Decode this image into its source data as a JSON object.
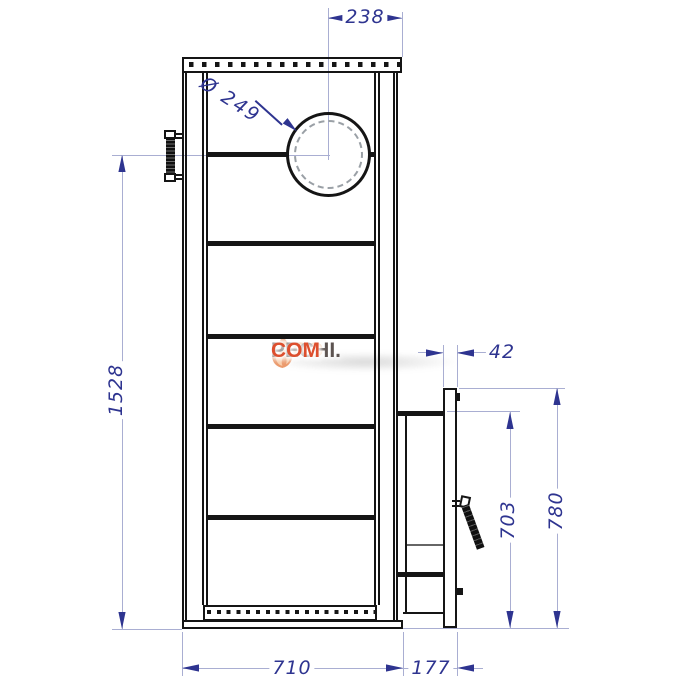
{
  "title": "Stove side-view technical drawing",
  "watermark": {
    "pro": "PRO",
    "pechi": "PECHI.",
    "com": "COM"
  },
  "dimensions": {
    "top_width": "238",
    "flue_diameter": "Ø 249",
    "total_height": "1528",
    "door_gap": "42",
    "door_height": "703",
    "door_total_height": "780",
    "base_width": "710",
    "door_depth": "177"
  },
  "colors": {
    "drawing": "#151515",
    "dimension_text": "#2e3490",
    "extension_line": "#a9aed2",
    "watermark_pro": "#ea8f3f",
    "watermark_pechi": "#5c5350",
    "watermark_com": "#dd4f2e",
    "flame_outer": "#eb9a6c",
    "flame_inner": "#f8cda9"
  }
}
